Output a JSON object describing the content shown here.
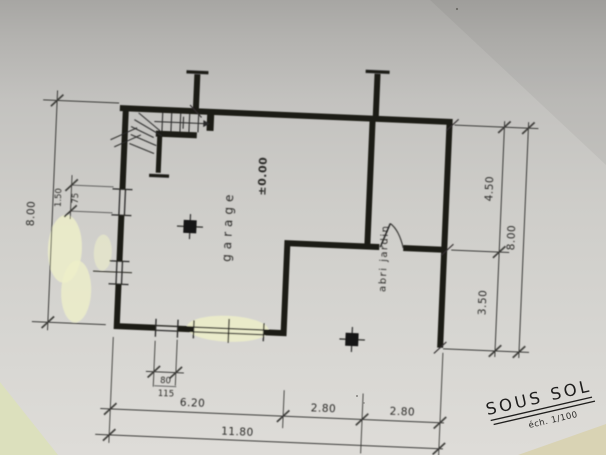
{
  "drawing": {
    "title": "SOUS SOL",
    "scale_note": "éch. 1/100",
    "rooms": {
      "garage": "garage",
      "level": "±0.00",
      "abri_jardin": "abri jardin"
    },
    "dimensions": {
      "left_overall": "8.00",
      "left_window_width": "1.50",
      "left_window_height": "75",
      "right_top": "4.50",
      "right_bottom": "3.50",
      "right_overall": "8.00",
      "bottom_seg1": "6.20",
      "bottom_seg2": "2.80",
      "bottom_seg3": "2.80",
      "bottom_overall": "11.80",
      "bottom_window_width": "80",
      "bottom_window_height": "115"
    },
    "colors": {
      "ink": "#1a1a19",
      "paper": "#cecdc9",
      "highlighter": "#edefc9",
      "surface_bottom_left": "#dce0bd",
      "surface_bottom_right": "#d9d3b4"
    }
  }
}
